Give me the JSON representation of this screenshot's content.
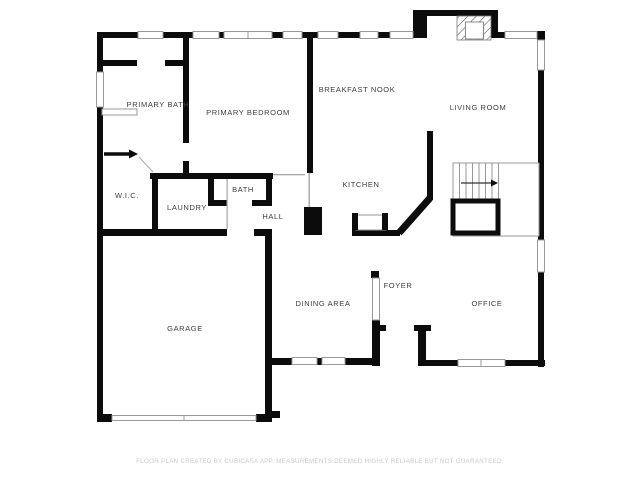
{
  "plan": {
    "rooms": [
      {
        "label": "PRIMARY BATH"
      },
      {
        "label": "PRIMARY BEDROOM"
      },
      {
        "label": "BREAKFAST NOOK"
      },
      {
        "label": "LIVING ROOM"
      },
      {
        "label": "W.I.C."
      },
      {
        "label": "LAUNDRY"
      },
      {
        "label": "BATH"
      },
      {
        "label": "HALL"
      },
      {
        "label": "KITCHEN"
      },
      {
        "label": "DINING AREA"
      },
      {
        "label": "FOYER"
      },
      {
        "label": "OFFICE"
      },
      {
        "label": "GARAGE"
      }
    ],
    "icons": [
      {
        "name": "stairs-direction-arrow"
      },
      {
        "name": "door-swing-arrow"
      },
      {
        "name": "fireplace-hatch"
      }
    ],
    "colors": {
      "wall": "#0c0c0c",
      "thin_line": "#999999",
      "label_text": "#3d3d3d",
      "disclaimer_text": "#c9c9c9",
      "background": "#ffffff"
    },
    "disclaimer": "FLOOR PLAN CREATED BY CUBICASA APP. MEASUREMENTS DEEMED HIGHLY RELIABLE BUT NOT GUARANTEED."
  }
}
